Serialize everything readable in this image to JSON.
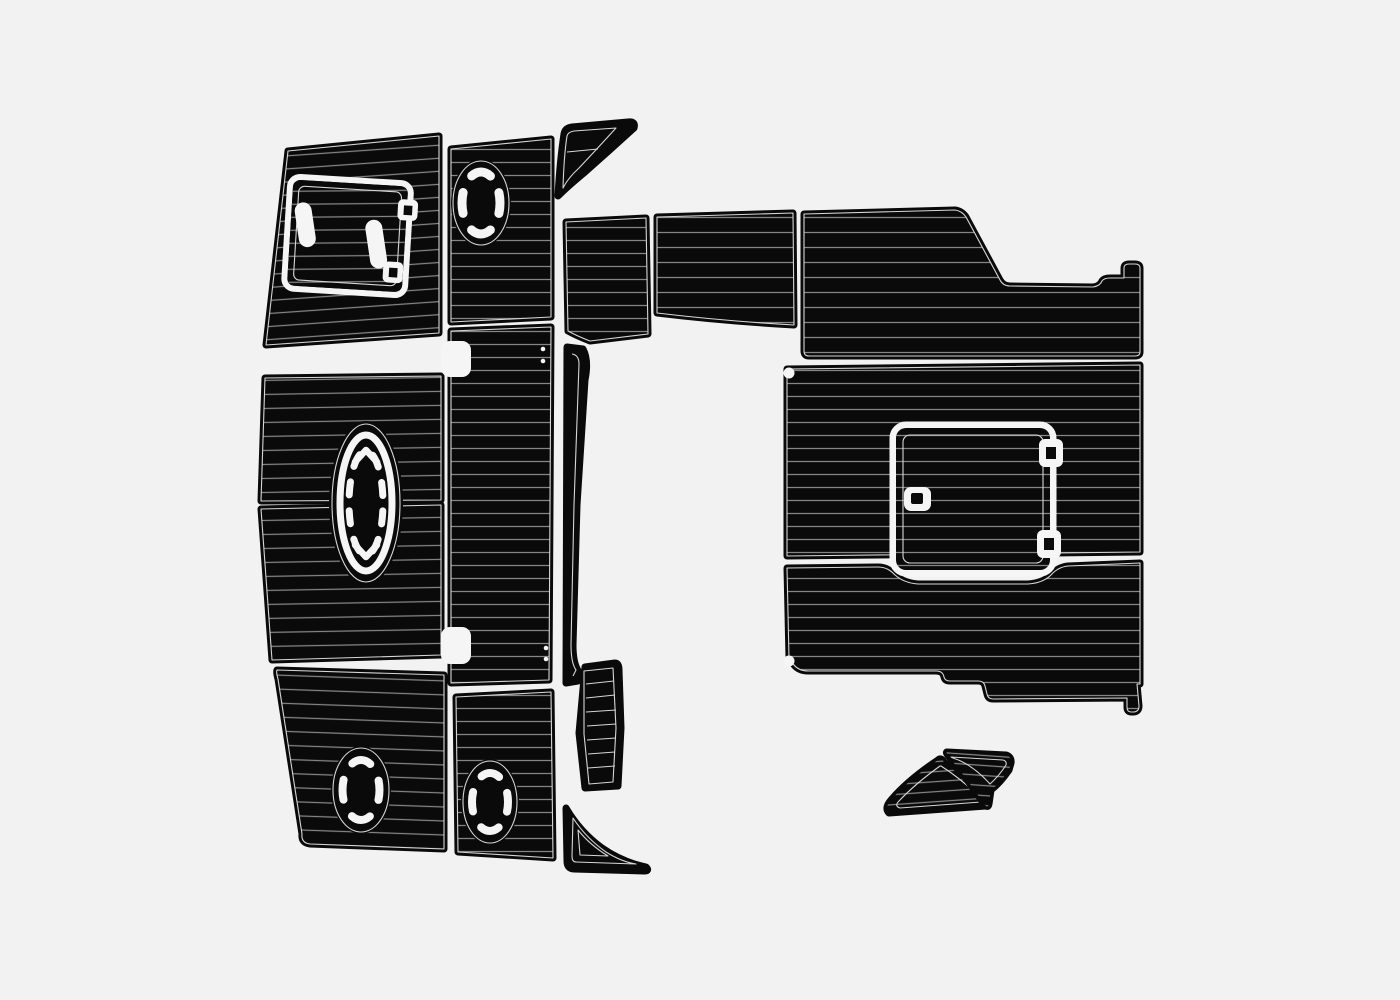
{
  "image": {
    "description": "Product illustration of a boat EVA foam teak-style decking pad set: black pads with routed plank lines laid out flat on a light background",
    "text_content": "none"
  },
  "colors": {
    "bg": "#f2f2f2",
    "ink": "#0a0a0a",
    "plank": "#858585",
    "groove": "#d6d6d6",
    "cut": "#f5f5f5"
  },
  "pieces": [
    {
      "id": "bow-pad",
      "label": "bow pad with anchor locker hatch"
    },
    {
      "id": "foredeck-forward-pad",
      "label": "foredeck forward pad"
    },
    {
      "id": "foredeck-aft-pad",
      "label": "foredeck aft pad"
    },
    {
      "id": "cockpit-port-pad",
      "label": "cockpit port pad with oval hatch"
    },
    {
      "id": "cockpit-center-pad",
      "label": "cockpit center pad with oval hatch"
    },
    {
      "id": "forward-step-pad",
      "label": "forward step pad with oval hatch"
    },
    {
      "id": "center-walkway-pad",
      "label": "center walkway pad with notches"
    },
    {
      "id": "gunwale-sliver-trim",
      "label": "gunwale sliver trim"
    },
    {
      "id": "bow-wing-trim",
      "label": "curved bow wing trim"
    },
    {
      "id": "side-step-pad",
      "label": "side step pad"
    },
    {
      "id": "ladder-step-pad",
      "label": "ladder step pad"
    },
    {
      "id": "stern-wedge-trim",
      "label": "curved stern wedge trim"
    },
    {
      "id": "transom-box-small-pad",
      "label": "small transom box pad"
    },
    {
      "id": "transom-box-wide-pad",
      "label": "wide transom box pad with notch"
    },
    {
      "id": "swim-platform-upper-pad",
      "label": "swim platform upper pad with engine hatch door"
    },
    {
      "id": "swim-platform-lower-pad",
      "label": "swim platform lower pad"
    },
    {
      "id": "corner-wedge-left-pad",
      "label": "left corner wedge pad"
    },
    {
      "id": "corner-wedge-right-pad",
      "label": "right corner wedge pad"
    }
  ],
  "details": {
    "anchor_hatch": "tilted door with two oblong handle cutouts and two hinge tabs",
    "engine_hatch": "rounded square door with two right-side hinges and left latch",
    "oval_inserts": "ellipse cutouts with dashed white arc rings",
    "center_oval": "tall oval insert with chevron and dash markings"
  }
}
